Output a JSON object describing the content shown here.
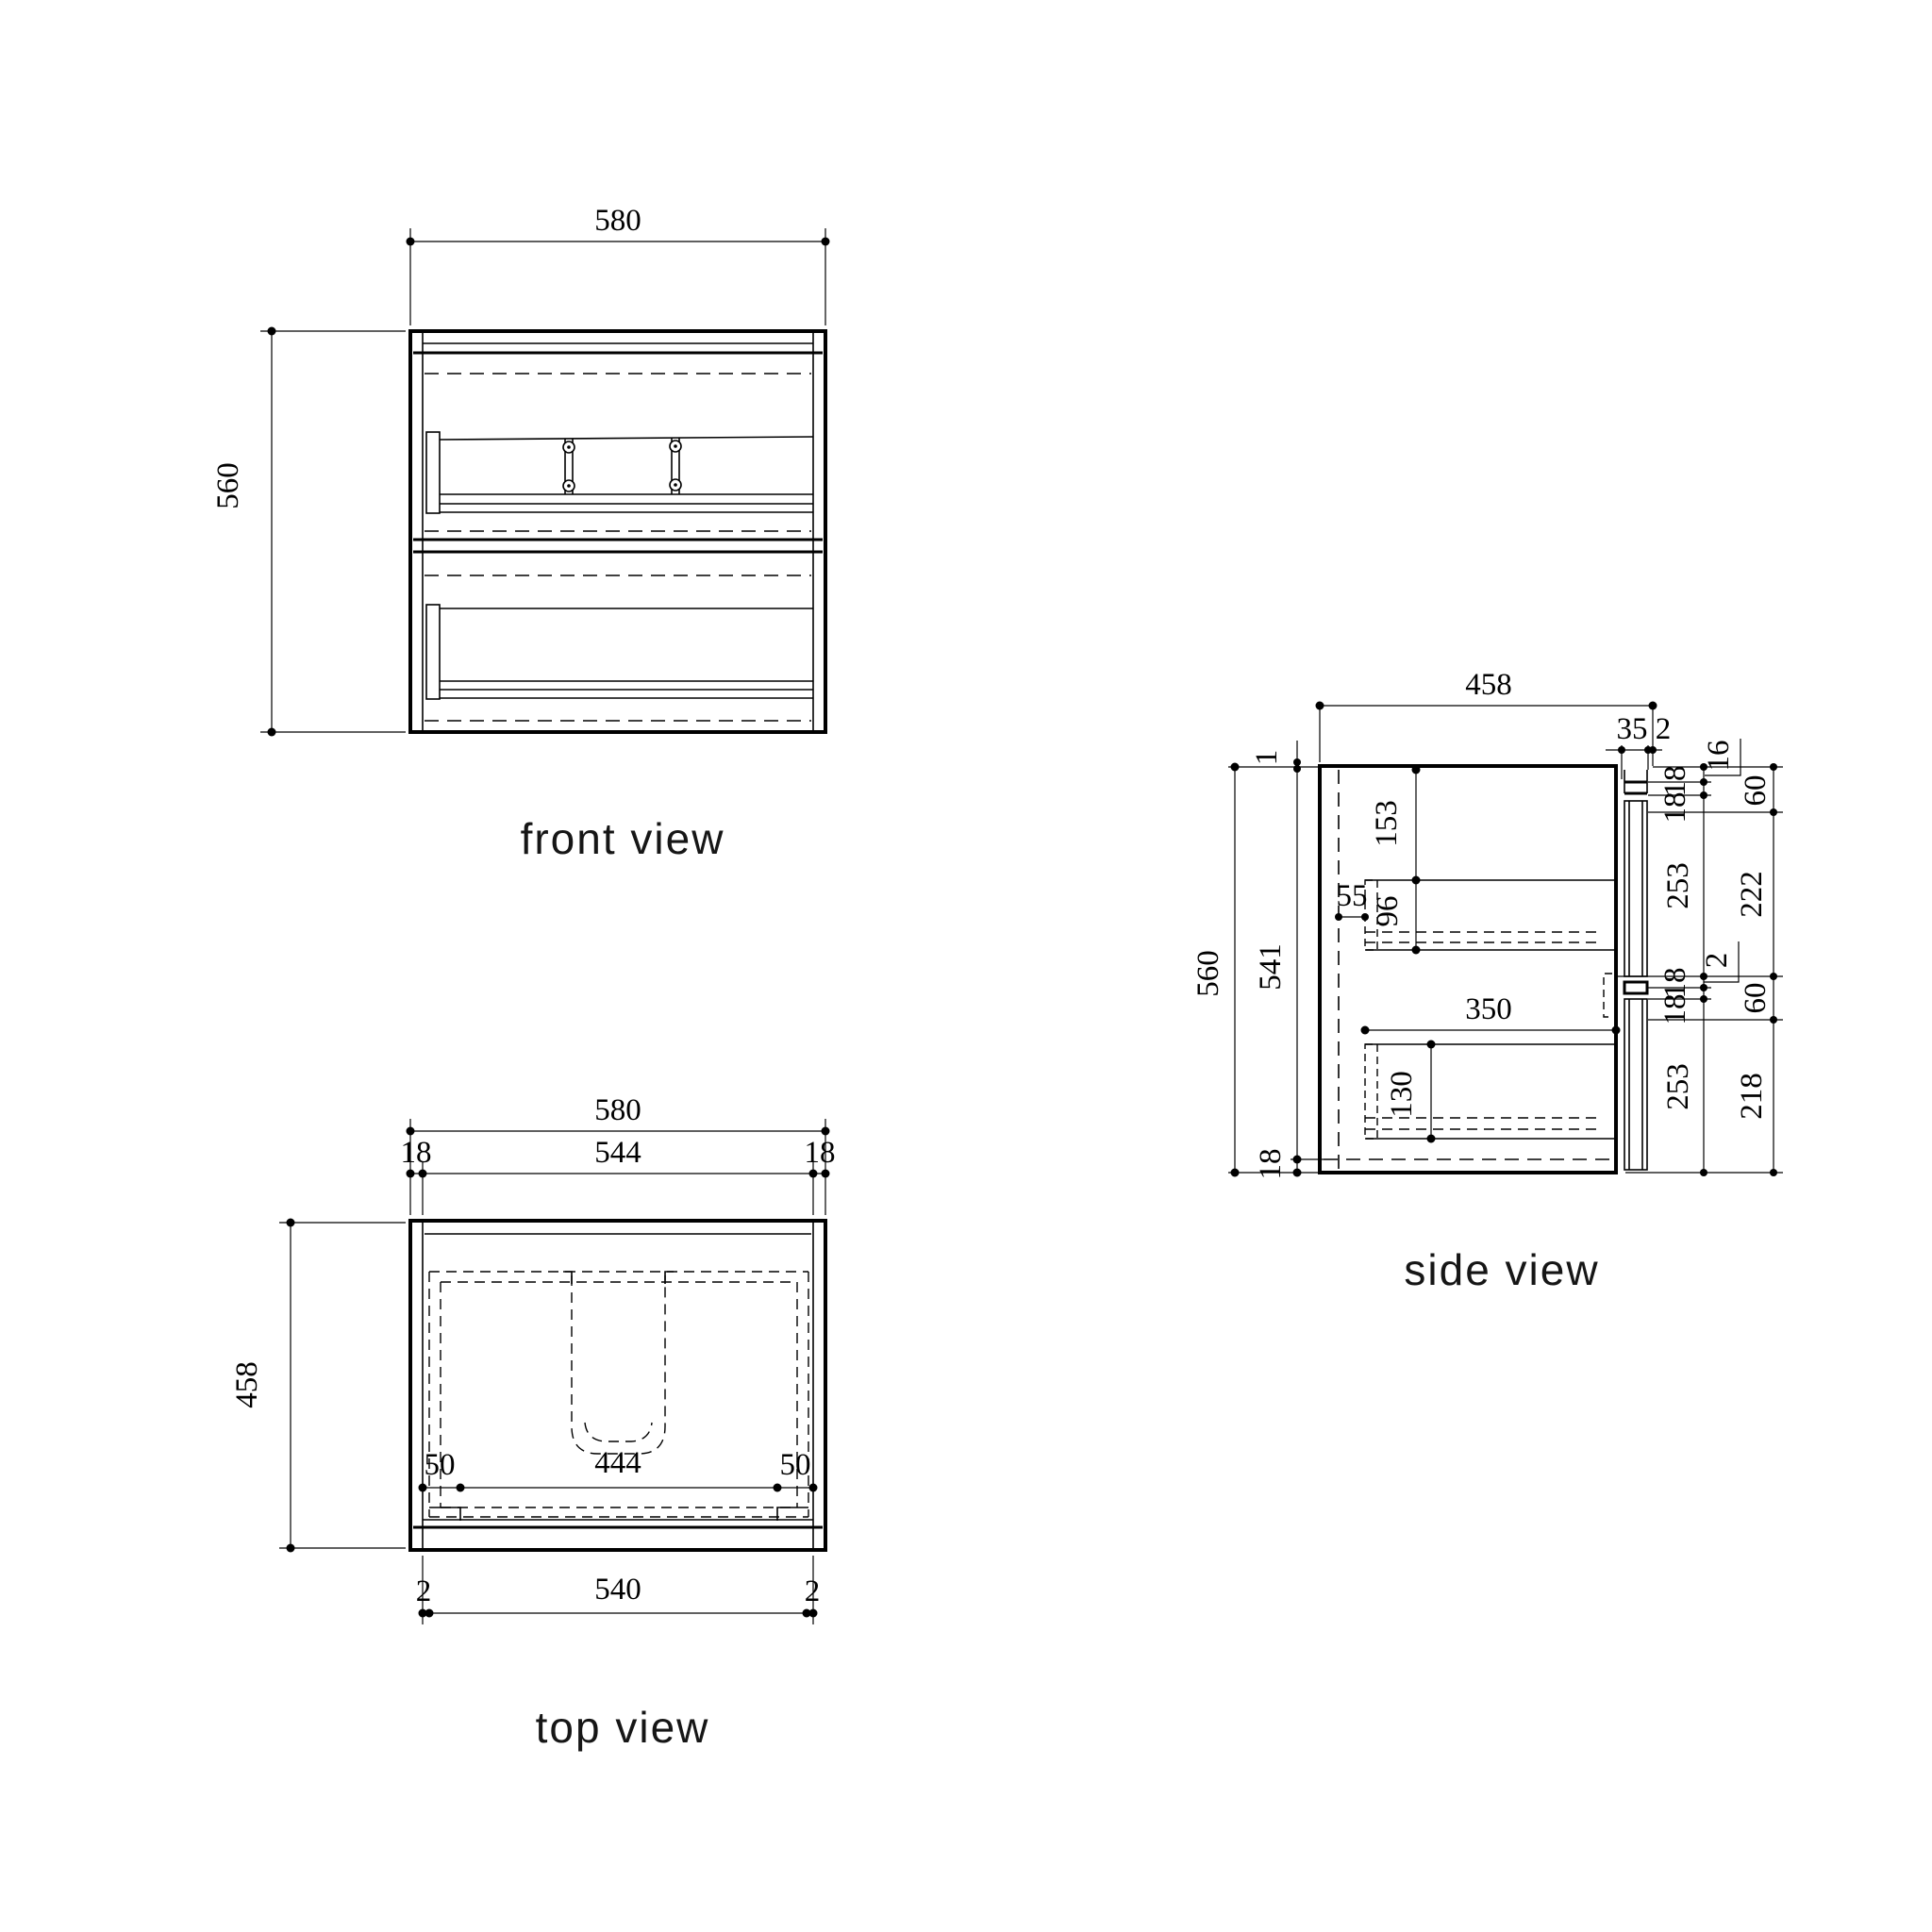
{
  "drawing": {
    "title": "cabinet orthographic views",
    "background_color": "#ffffff",
    "line_color": "#000000"
  },
  "views": {
    "front": {
      "label": "front view",
      "dims": {
        "width": "580",
        "height": "560"
      }
    },
    "top": {
      "label": "top view",
      "dims": {
        "width": "580",
        "wall_left": "18",
        "inner_width": "544",
        "wall_right": "18",
        "depth": "458",
        "basin_offset_left": "50",
        "basin_width": "444",
        "basin_offset_right": "50",
        "gap_left": "2",
        "bottom_width": "540",
        "gap_right": "2"
      }
    },
    "side": {
      "label": "side view",
      "dims": {
        "depth": "458",
        "front_thickness": "35",
        "front_gap": "2",
        "top_rail": "16",
        "height": "560",
        "inner_height": "541",
        "top_clearance": "1",
        "bottom_panel": "18",
        "top_drawer_offset": "153",
        "top_drawer_side": "96",
        "back_clearance": "55",
        "mid_gap": "2",
        "bottom_drawer_depth": "350",
        "bottom_drawer_side": "130",
        "right_inner": [
          "18",
          "18",
          "253",
          "18",
          "18",
          "253"
        ],
        "right_outer": [
          "60",
          "222",
          "60",
          "218"
        ]
      }
    }
  }
}
